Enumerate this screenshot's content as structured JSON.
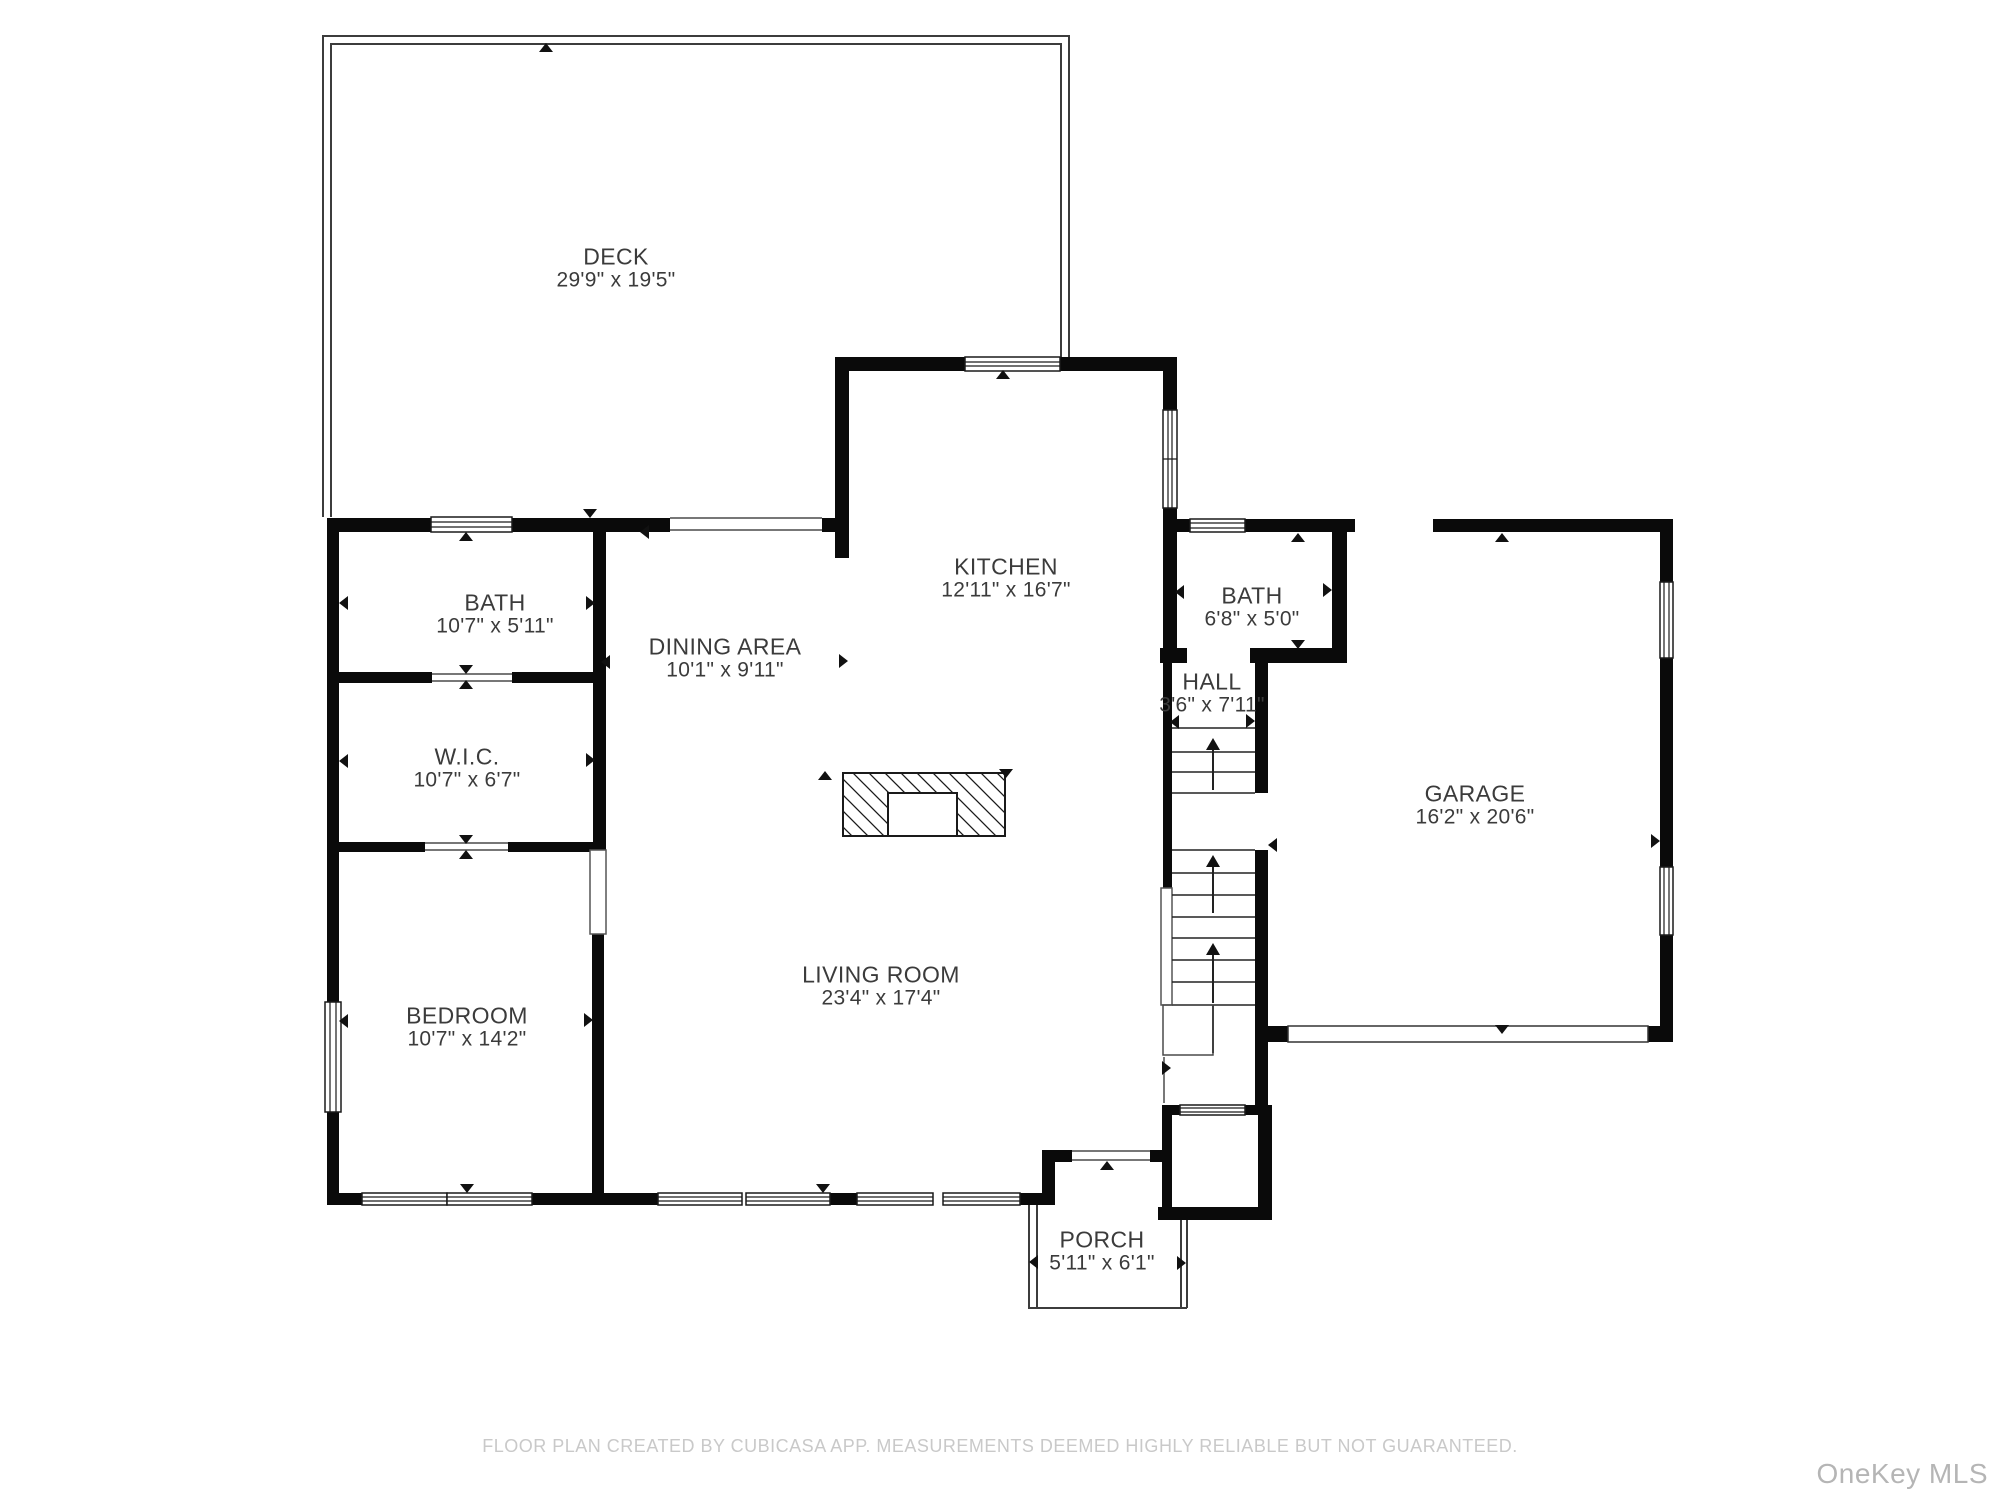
{
  "colors": {
    "wall": "#0a0a0a",
    "thin_line": "#3c3c3c",
    "label_text": "#3b3b3b",
    "footer_text": "#c9c9c9",
    "watermark_text": "#b5b5b5"
  },
  "rooms": [
    {
      "id": "deck",
      "name": "DECK",
      "dims": "29'9\" x 19'5\""
    },
    {
      "id": "bath-left",
      "name": "BATH",
      "dims": "10'7\" x 5'11\""
    },
    {
      "id": "dining-area",
      "name": "DINING AREA",
      "dims": "10'1\" x 9'11\""
    },
    {
      "id": "kitchen",
      "name": "KITCHEN",
      "dims": "12'11\" x 16'7\""
    },
    {
      "id": "bath-right",
      "name": "BATH",
      "dims": "6'8\" x 5'0\""
    },
    {
      "id": "hall",
      "name": "HALL",
      "dims": "3'6\" x 7'11\""
    },
    {
      "id": "wic",
      "name": "W.I.C.",
      "dims": "10'7\" x 6'7\""
    },
    {
      "id": "garage",
      "name": "GARAGE",
      "dims": "16'2\" x 20'6\""
    },
    {
      "id": "bedroom",
      "name": "BEDROOM",
      "dims": "10'7\" x 14'2\""
    },
    {
      "id": "living-room",
      "name": "LIVING ROOM",
      "dims": "23'4\" x 17'4\""
    },
    {
      "id": "porch",
      "name": "PORCH",
      "dims": "5'11\" x 6'1\""
    }
  ],
  "footer": {
    "disclaimer": "FLOOR PLAN CREATED BY CUBICASA APP. MEASUREMENTS DEEMED HIGHLY RELIABLE BUT NOT GUARANTEED."
  },
  "watermark": {
    "text": "OneKey MLS"
  }
}
